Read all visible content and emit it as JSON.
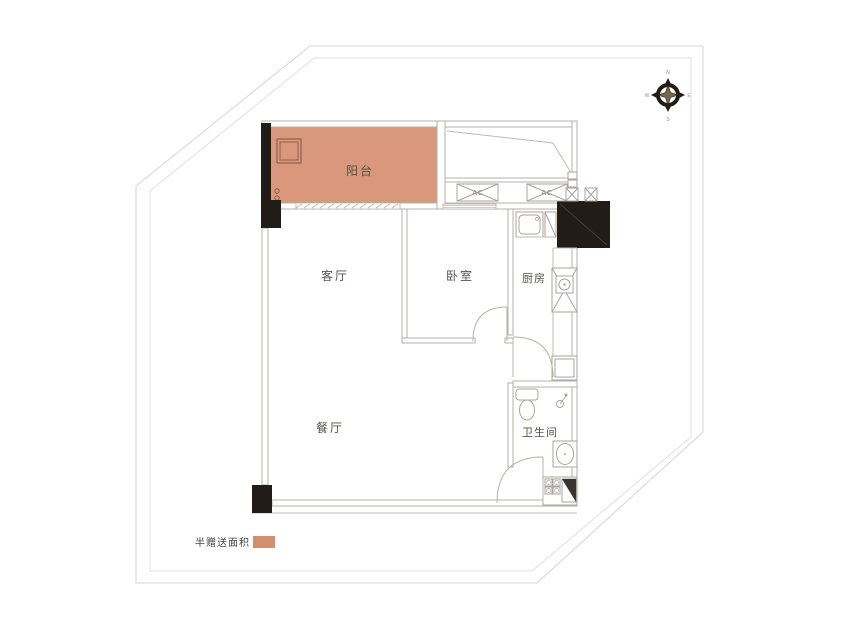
{
  "rooms": {
    "balcony": "阳台",
    "living_room": "客厅",
    "bedroom": "卧室",
    "kitchen": "厨房",
    "dining_room": "餐厅",
    "bathroom": "卫生间"
  },
  "ac_units": {
    "ac1": "AC",
    "ac2": "AC"
  },
  "legend": {
    "label": "半赠送面积",
    "swatch_color": "#d28e6e"
  },
  "compass": {
    "north": "N",
    "east": "E",
    "south": "S",
    "west": "W"
  },
  "colors": {
    "gift_area": "#d9977b",
    "column": "#211c18",
    "wall_line": "#b6b0aa"
  }
}
